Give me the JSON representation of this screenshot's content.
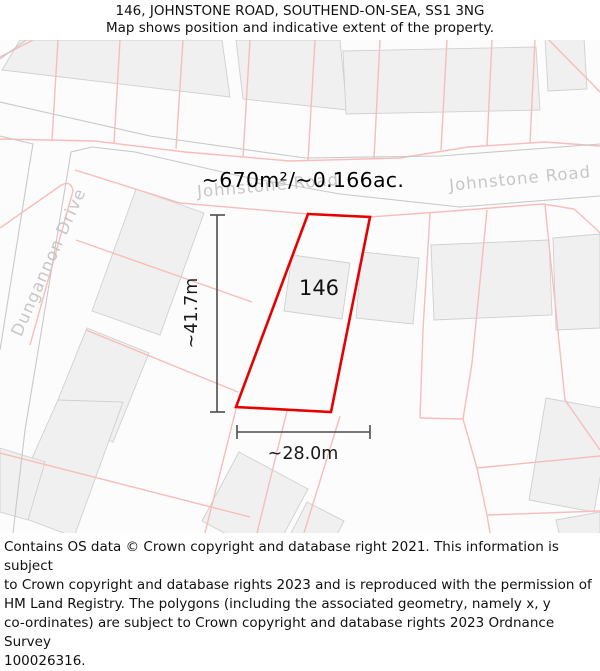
{
  "header": {
    "title": "146, JOHNSTONE ROAD, SOUTHEND-ON-SEA, SS1 3NG",
    "subtitle": "Map shows position and indicative extent of the property."
  },
  "map": {
    "property": {
      "number": "146",
      "area_label": "~670m²/~0.166ac.",
      "width_label": "~28.0m",
      "height_label": "~41.7m"
    },
    "roads": {
      "johnstone": "Johnstone Road",
      "dungannon": "Dungannon Drive"
    },
    "colors": {
      "property_boundary": "#e60000",
      "parcel_line": "#f7bdbb",
      "road_edge": "#c9c9c9",
      "building_fill": "#f0f0f0",
      "road_label": "#c7c7c7"
    }
  },
  "footer": {
    "text": "Contains OS data © Crown copyright and database right 2021. This information is subject\nto Crown copyright and database rights 2023 and is reproduced with the permission of\nHM Land Registry. The polygons (including the associated geometry, namely x, y\nco-ordinates) are subject to Crown copyright and database rights 2023 Ordnance Survey\n100026316."
  }
}
